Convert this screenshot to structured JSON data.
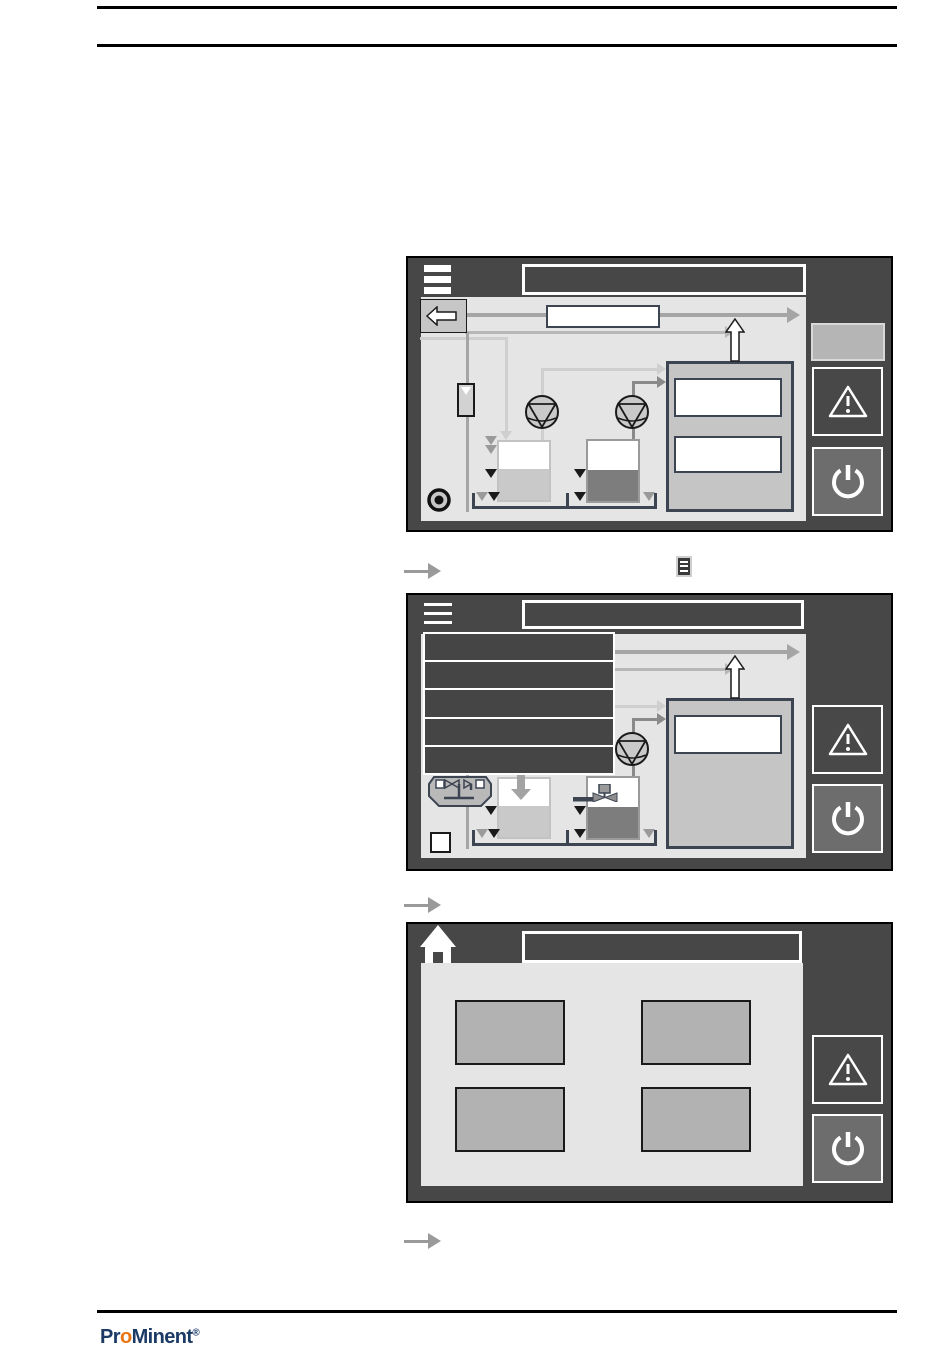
{
  "colors": {
    "panel-bg": "#474747",
    "screen-bg": "#e5e5e5",
    "menu-bg": "#454545",
    "pipe": "#a5a5a5",
    "pipe-light": "#cfcfcf",
    "pipe-mid": "#8a8a8a",
    "pipe2": "#b7b7b7",
    "outline": "#3d4553",
    "ink": "#1a1a1a",
    "tri-gray": "#9a9a9a",
    "btn-gray": "#b5b5b5",
    "btn-gray-border": "#d8d8d8",
    "power-btn": "#6d6d6d",
    "warn-btn": "#484848",
    "back-btn": "#c6c6c6",
    "tank-light": "#c9c9c9",
    "tank-dark": "#7d7d7d",
    "tile": "#b2b2b2",
    "arrow-gray": "#9a9a9a",
    "logo-navy": "#1b3a66",
    "logo-orange": "#e87511",
    "slate": "#4a5564"
  },
  "logo": {
    "pr": "Pr",
    "o": "o",
    "minent": "Minent",
    "registered": "®"
  },
  "screens": [
    {
      "name": "process-overview-screen",
      "header_icon": "menu-hamburger-icon",
      "title": "",
      "diagram_icons": [
        "back-arrow-button",
        "flow-meter",
        "pump",
        "pump",
        "tank-light",
        "tank-dark",
        "treatment-unit",
        "up-arrow",
        "record-indicator"
      ],
      "sidebar": [
        "status-field",
        "warning-button",
        "power-button"
      ]
    },
    {
      "name": "process-overview-menu-open",
      "header_icon": "menu-hamburger-icon",
      "title": "",
      "menu_items": [
        "",
        "",
        "",
        "",
        ""
      ],
      "diagram_icons": [
        "valve-manifold",
        "dosing-arrow",
        "motor-valve",
        "pump",
        "tank-light",
        "tank-dark",
        "treatment-unit",
        "up-arrow",
        "stop-indicator"
      ],
      "sidebar": [
        "warning-button",
        "power-button"
      ]
    },
    {
      "name": "home-screen",
      "header_icon": "home-icon",
      "title": "",
      "tiles": [
        "",
        "",
        "",
        ""
      ],
      "sidebar": [
        "warning-button",
        "power-button"
      ]
    }
  ],
  "captions": [
    {
      "arrow": "result-arrow",
      "inline_icon": "menu-button-icon"
    },
    {
      "arrow": "result-arrow"
    },
    {
      "arrow": "result-arrow"
    }
  ]
}
